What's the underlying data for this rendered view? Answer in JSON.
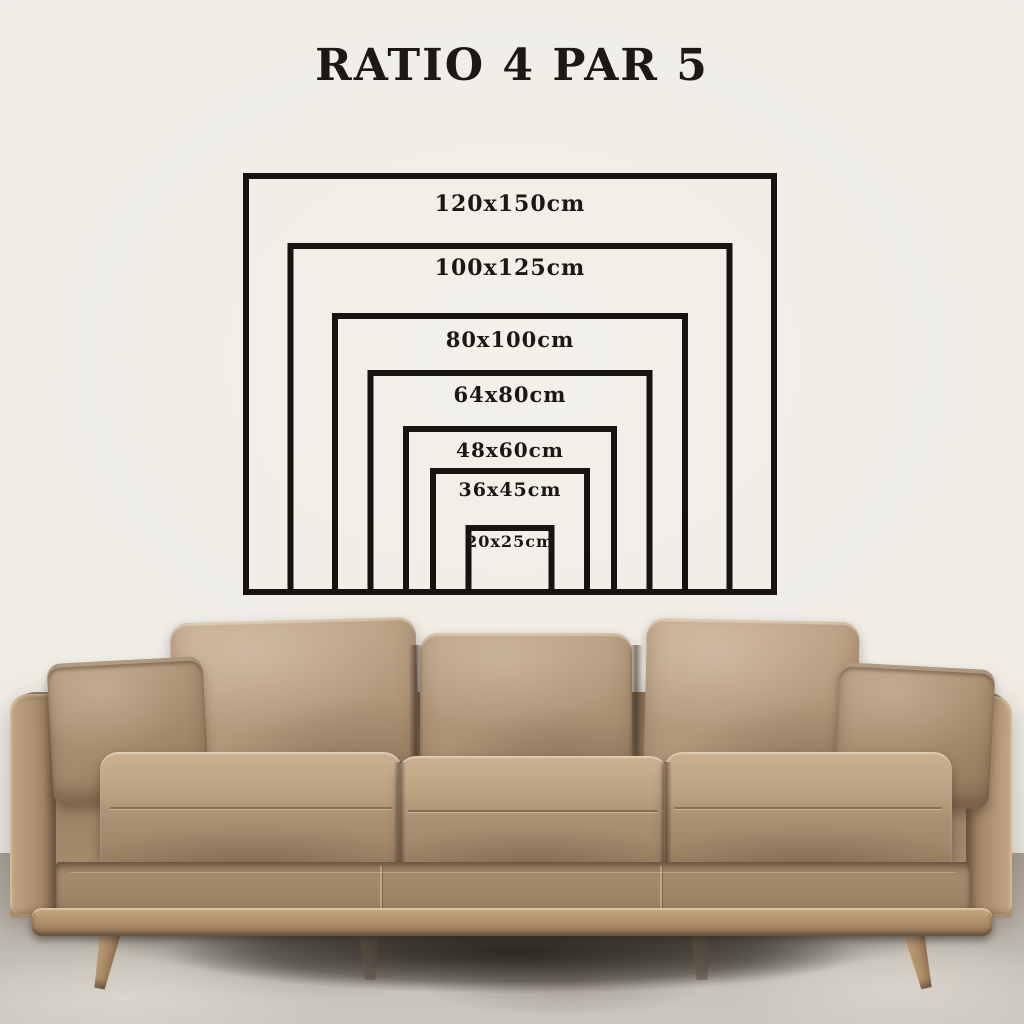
{
  "title": "RATIO 4 PAR 5",
  "size_chart": {
    "type": "nested-rectangles",
    "items": [
      {
        "label": "120x150cm",
        "short_cm": 120,
        "long_cm": 150,
        "font_px": 22,
        "pad_px": 13
      },
      {
        "label": "100x125cm",
        "short_cm": 100,
        "long_cm": 125,
        "font_px": 22,
        "pad_px": 7
      },
      {
        "label": "80x100cm",
        "short_cm": 80,
        "long_cm": 100,
        "font_px": 21,
        "pad_px": 9
      },
      {
        "label": "64x80cm",
        "short_cm": 64,
        "long_cm": 80,
        "font_px": 21,
        "pad_px": 7
      },
      {
        "label": "48x60cm",
        "short_cm": 48,
        "long_cm": 60,
        "font_px": 20,
        "pad_px": 7
      },
      {
        "label": "36x45cm",
        "short_cm": 36,
        "long_cm": 45,
        "font_px": 19,
        "pad_px": 6
      },
      {
        "label": "20x25cm",
        "short_cm": 20,
        "long_cm": 25,
        "font_px": 16,
        "pad_px": 2
      }
    ],
    "layout": {
      "left_px": 243,
      "top_px": 173,
      "px_per_cm_wide": 3.56,
      "px_per_cm_tall": 3.52,
      "border_px": 6
    },
    "line_color": "#17130e",
    "label_color": "#1b1712"
  },
  "scene": {
    "wall_color": "#efece6",
    "floor_color": "#c0bbb3",
    "sofa_colors": {
      "leather": "#b3987a",
      "leather_light": "#c9b092",
      "leather_dark": "#8c7155",
      "wood": "#b08d68"
    }
  }
}
